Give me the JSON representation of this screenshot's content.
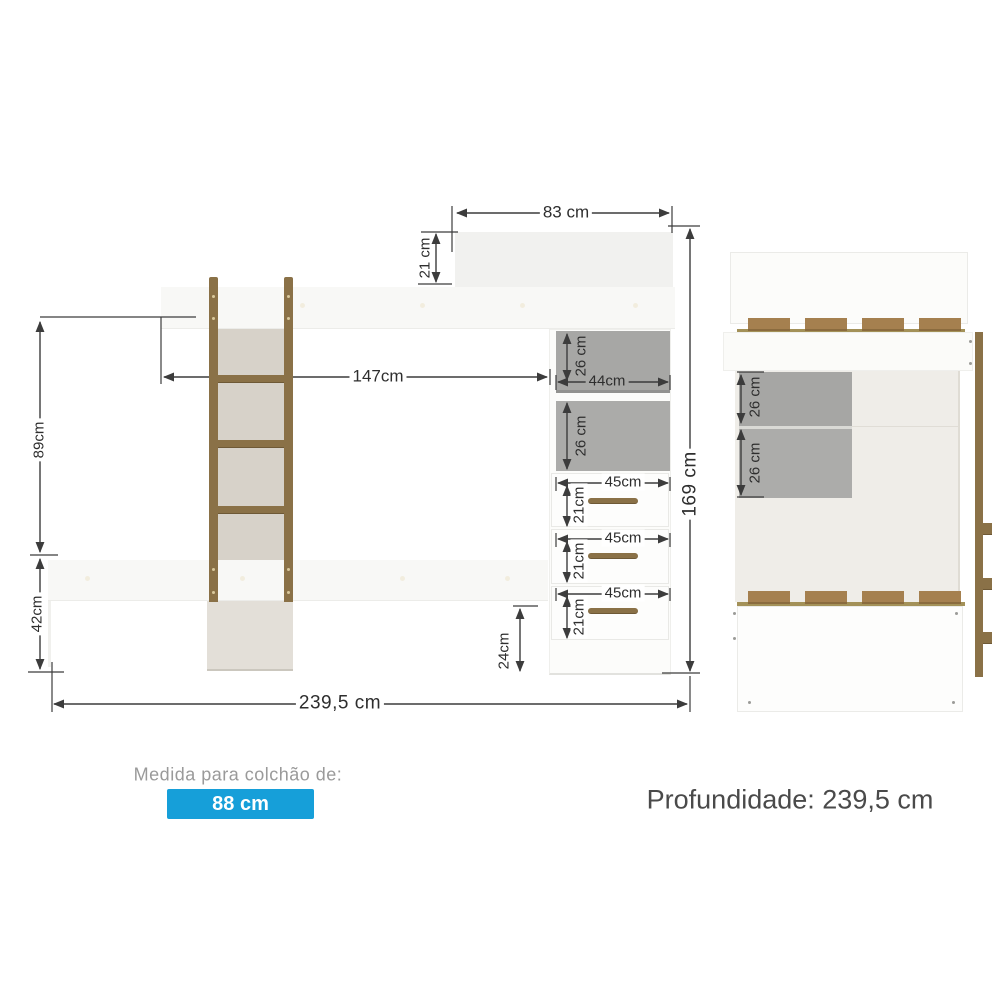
{
  "front_view": {
    "dim_top_width": "83 cm",
    "dim_top_depth": "21 cm",
    "dim_bed_length": "147cm",
    "dim_upper_height": "89cm",
    "dim_lower_height": "42cm",
    "dim_total_height": "169 cm",
    "dim_total_width": "239,5 cm",
    "dim_niche_width": "44cm",
    "dim_base_height": "24cm",
    "shelves": [
      {
        "height": "26 cm"
      },
      {
        "height": "26 cm"
      }
    ],
    "drawers": [
      {
        "width": "45cm",
        "height": "21cm"
      },
      {
        "width": "45cm",
        "height": "21cm"
      },
      {
        "width": "45cm",
        "height": "21cm"
      }
    ]
  },
  "side_view": {
    "shelves": [
      {
        "height": "26 cm"
      },
      {
        "height": "26 cm"
      }
    ]
  },
  "footer": {
    "mattress_label": "Medida para colchão de:",
    "mattress_size": "88 cm",
    "depth_text": "Profundidade: 239,5 cm"
  },
  "colors": {
    "accent_blue": "#169FD9",
    "wood_brown": "#8A7147",
    "shelf_gray": "#A7A7A5",
    "panel_beige": "#D7D2C9",
    "dim_line": "#3C3C3C"
  }
}
